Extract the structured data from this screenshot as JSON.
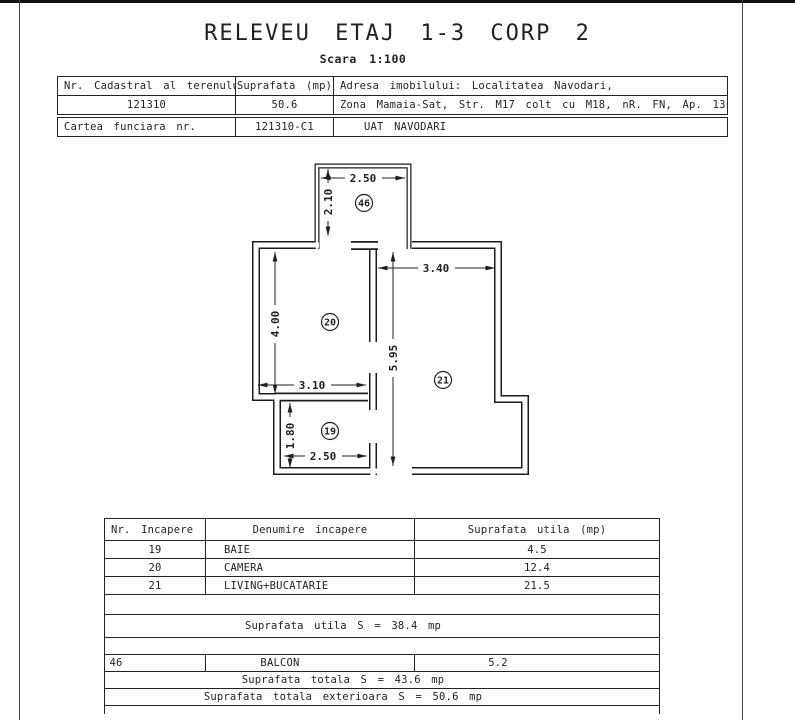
{
  "page": {
    "title": "RELEVEU ETAJ 1-3 CORP 2",
    "scale": "Scara 1:100"
  },
  "info_table": {
    "col1_header": "Nr. Cadastral al terenului",
    "col2_header": "Suprafata (mp)",
    "col3_header": "Adresa imobilului: Localitatea Navodari,",
    "cadastral_number": "121310",
    "area": "50.6",
    "address_line2": "Zona Mamaia-Sat, Str. M17 colt cu M18, nR. FN, Ap. 13si 31",
    "cartea_funciara_label": "Cartea funciara nr.",
    "cartea_funciara_value": "121310-C1",
    "uat": "UAT NAVODARI"
  },
  "floor_plan": {
    "dims": {
      "balcony_width": "2.50",
      "balcony_depth": "2.10",
      "living_width": "3.40",
      "camera_height": "4.00",
      "middle_height": "5.95",
      "camera_width": "3.10",
      "baie_height": "1.80",
      "baie_width": "2.50"
    },
    "room_numbers": {
      "balcon": "46",
      "camera": "20",
      "living": "21",
      "baie": "19"
    }
  },
  "room_table": {
    "headers": [
      "Nr. Incapere",
      "Denumire incapere",
      "Suprafata utila (mp)"
    ],
    "rows": [
      {
        "nr": "19",
        "name": "BAIE",
        "area": "4.5"
      },
      {
        "nr": "20",
        "name": "CAMERA",
        "area": "12.4"
      },
      {
        "nr": "21",
        "name": "LIVING+BUCATARIE",
        "area": "21.5"
      }
    ],
    "suprafata_utila": "Suprafata utila S = 38.4 mp",
    "balcon_row": {
      "nr": "46",
      "name": "BALCON",
      "area": "5.2"
    },
    "suprafata_totala": "Suprafata totala S = 43.6 mp",
    "suprafata_totala_exterioara": "Suprafata totala exterioara S = 50.6 mp"
  }
}
